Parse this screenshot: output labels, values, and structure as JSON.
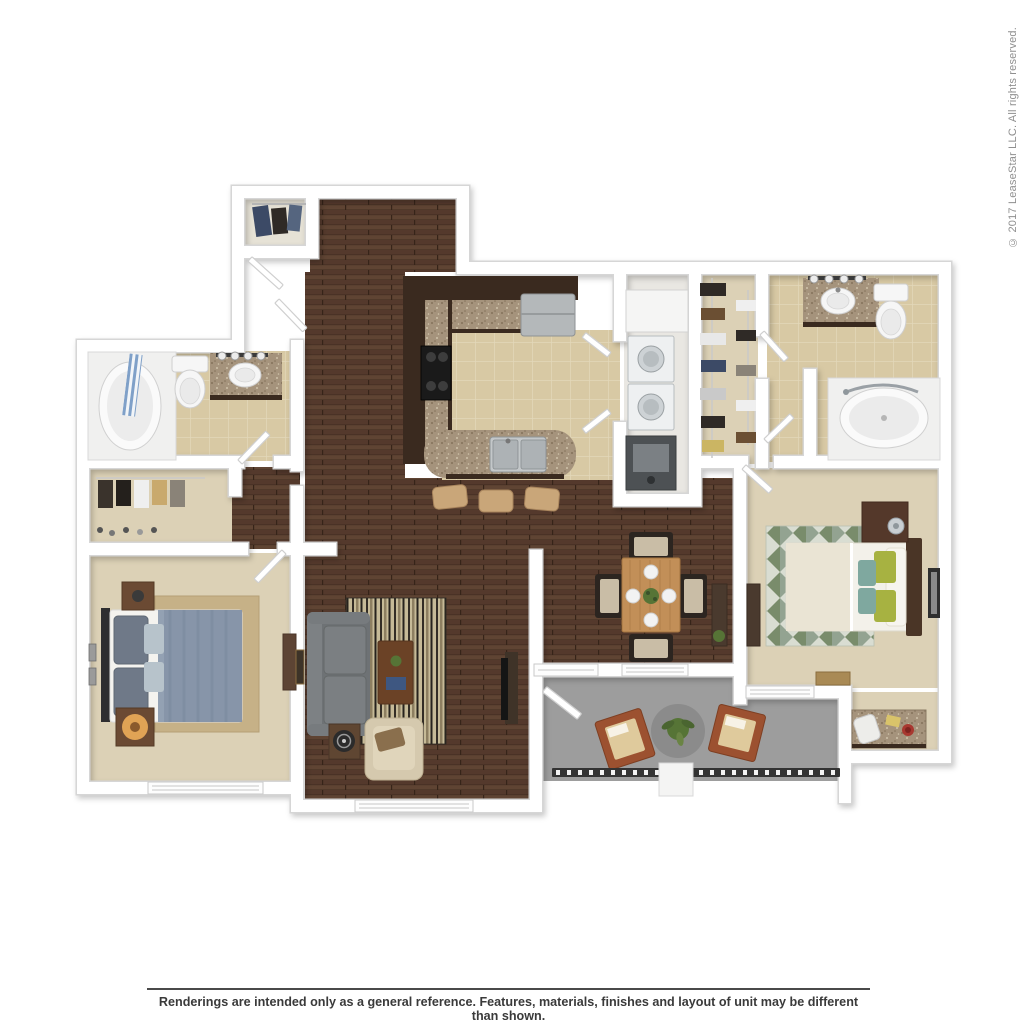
{
  "copyright": "© 2017 LeaseStar LLC. All rights reserved.",
  "disclaimer": "Renderings are intended only as a general reference. Features, materials, finishes and layout of unit may be different than shown.",
  "colors": {
    "wall": "#ffffff",
    "wallEdge": "#d6d6d6",
    "wood1": "#54392c",
    "wood2": "#5f4433",
    "woodSeam": "#362419",
    "tile": "#d8c9a4",
    "tileLine": "#e3d8ba",
    "carpet": "#dcd1b6",
    "carpetLight": "#e6e2d6",
    "concrete": "#9d9d9d",
    "granite": "#a5937c",
    "graniteDot1": "#84725b",
    "graniteDot2": "#cfc1a9",
    "cabinet": "#3a2a1f",
    "sofa": "#6e7275",
    "bedBlue": "#8795a9",
    "rugTan": "#c6b187",
    "rugOlive": "#798c6b",
    "rugSage": "#93a391",
    "limePillow": "#a7b241",
    "tealPillow": "#7fa89f",
    "tableOak": "#c28f58",
    "chairDark": "#2c2520",
    "seatTan": "#c9bda6",
    "patioChair": "#9c5130",
    "patioCushion": "#dfca9c",
    "railing": "#333333",
    "plant": "#567436",
    "lampGlow": "#f5b35c",
    "curtainBlue": "#7fa0c8",
    "textGray": "#8f8f8f",
    "textDark": "#3a3a3a"
  }
}
